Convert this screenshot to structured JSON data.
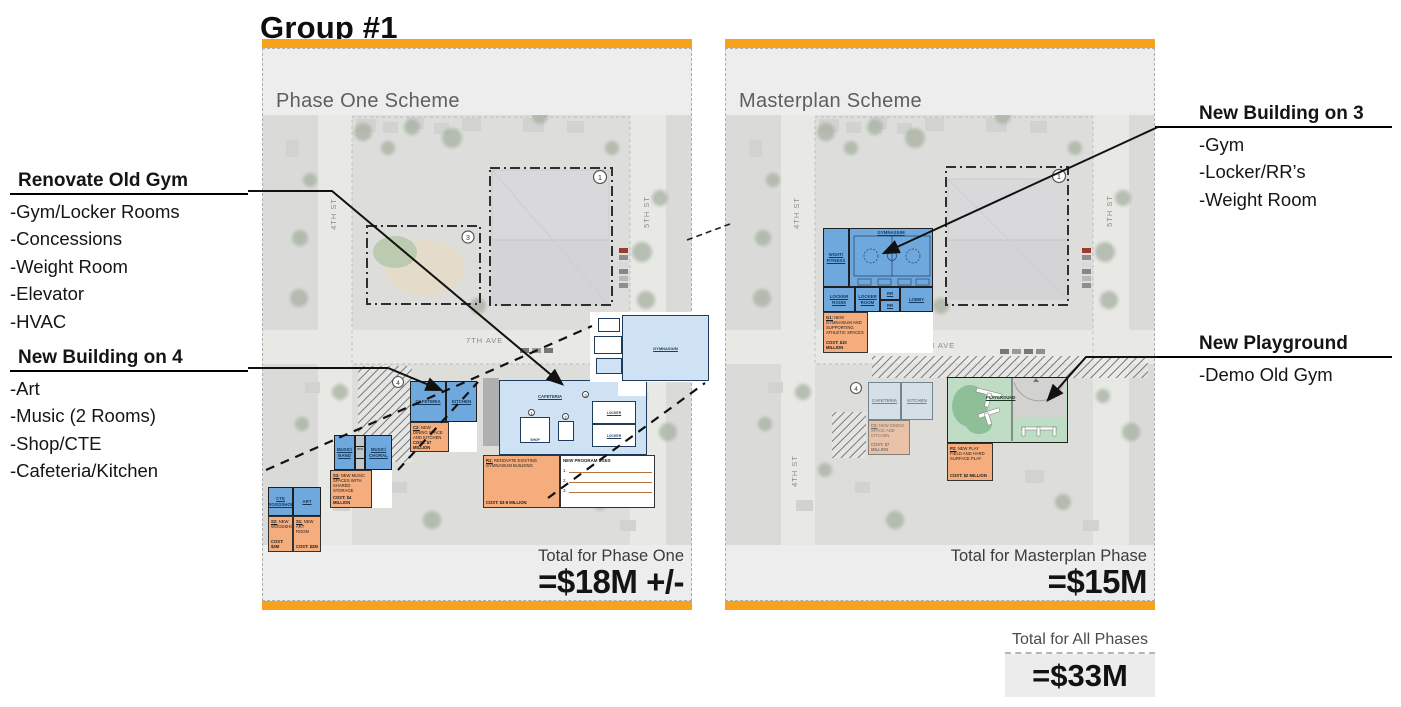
{
  "title": "Group #1",
  "panels": {
    "phase_one": {
      "scheme_label": "Phase One Scheme",
      "total_label": "Total for Phase One",
      "total_value": "=$18M +/-"
    },
    "masterplan": {
      "scheme_label": "Masterplan Scheme",
      "total_label": "Total for Masterplan Phase",
      "total_value": "=$15M"
    }
  },
  "grand_total": {
    "label": "Total for All Phases",
    "value": "=$33M"
  },
  "annotations": {
    "renovate_old_gym": {
      "heading": "Renovate Old Gym",
      "items": [
        "-Gym/Locker Rooms",
        "-Concessions",
        "-Weight Room",
        "-Elevator",
        "-HVAC"
      ]
    },
    "new_building_on_4": {
      "heading": "New Building on 4",
      "items": [
        "-Art",
        "-Music (2 Rooms)",
        "-Shop/CTE",
        "-Cafeteria/Kitchen"
      ]
    },
    "new_building_on_3": {
      "heading": "New Building on 3",
      "items": [
        "-Gym",
        "-Locker/RR’s",
        "-Weight Room"
      ]
    },
    "new_playground": {
      "heading": "New Playground",
      "items": [
        "-Demo Old Gym"
      ]
    }
  },
  "streets": {
    "st4": "4TH ST",
    "st5": "5TH ST",
    "st6": "6TH ST",
    "ave7": "7TH AVE"
  },
  "markers": {
    "n1": "1",
    "n2": "2",
    "n3": "3",
    "n4": "4"
  },
  "program": {
    "labels": {
      "cafeteria": "CAFETERIA",
      "kitchen": "KITCHEN",
      "music_band": "MUSIC/ BAND",
      "sto": "STO",
      "music_choral": "MUSIC/ CHORAL",
      "cte_woodshop": "CTE WOODSHOP",
      "art": "ART",
      "wght_fitness": "WGHT/ FITNESS",
      "gymnasium": "GYMNASIUM",
      "locker_room": "LOCKER ROOM",
      "rr": "RR",
      "lobby": "LOBBY",
      "playground": "PLAYGROUND",
      "shop": "SHOP",
      "locker": "LOCKER"
    },
    "notes": {
      "c2": {
        "code": "C2:",
        "text": "NEW DINING SPACE AND KITCHEN",
        "cost": "COST: $7 MILLION"
      },
      "s3": {
        "code": "S3:",
        "text": "NEW MUSIC SPACES WITH SHARED STORAGE",
        "cost": "COST: $4 MILLION"
      },
      "s2": {
        "code": "S2:",
        "text": "NEW WOODSHOP",
        "cost": "COST: $2M"
      },
      "s1": {
        "code": "S1:",
        "text": "NEW ART ROOM",
        "cost": "COST: $2M"
      },
      "r1": {
        "code": "R1:",
        "text": "RENOVATE EXISTING GYMNASIUM BUILDING",
        "cost": "COST: $3-8 MILLION"
      },
      "g1": {
        "code": "G1:",
        "text": "NEW GYMNASIUM AND SUPPORTING ATHLETIC SPACES",
        "cost": "COST: $10 MILLION"
      },
      "p2": {
        "code": "P2:",
        "text": "NEW PLAY FIELD AND HARD SURFACE PLAY",
        "cost": "COST: $2 MILLION"
      },
      "uses": {
        "title": "NEW PROGRAM USES",
        "lines": [
          "1.",
          "2.",
          "3."
        ]
      }
    }
  },
  "colors": {
    "accent_orange": "#F6A21C",
    "note_orange": "#F5AD7E",
    "block_blue": "#6FA8DC",
    "plan_blue": "#CFE2F3",
    "playground_green": "#BFDCC4",
    "panel_gray": "#EDEDED"
  }
}
